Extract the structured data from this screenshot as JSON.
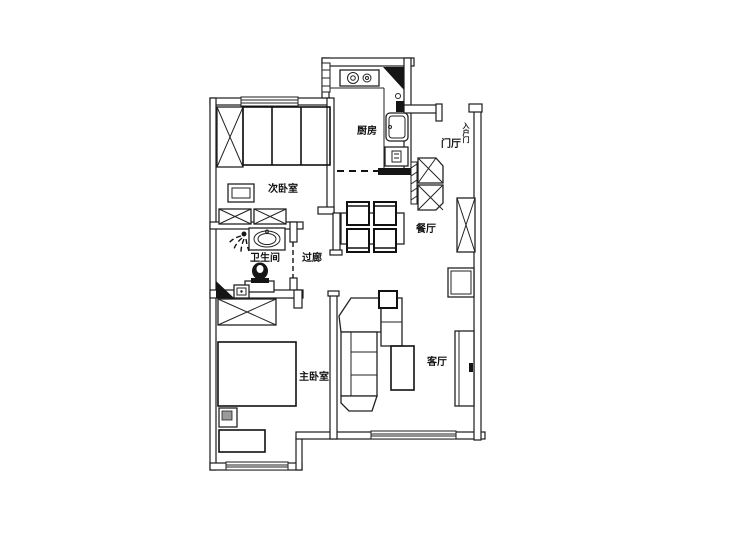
{
  "floorplan": {
    "colors": {
      "background": "#ffffff",
      "line": "#1b1b1b"
    },
    "rooms": {
      "kitchen": {
        "label": "厨房"
      },
      "entry_hall": {
        "label": "门厅"
      },
      "bedroom2": {
        "label": "次卧室"
      },
      "bathroom": {
        "label": "卫生间"
      },
      "corridor": {
        "label": "过廊"
      },
      "dining": {
        "label": "餐厅"
      },
      "master_bedroom": {
        "label": "主卧室"
      },
      "living_room": {
        "label": "客厅"
      }
    },
    "entry_door_label": "入户门"
  }
}
